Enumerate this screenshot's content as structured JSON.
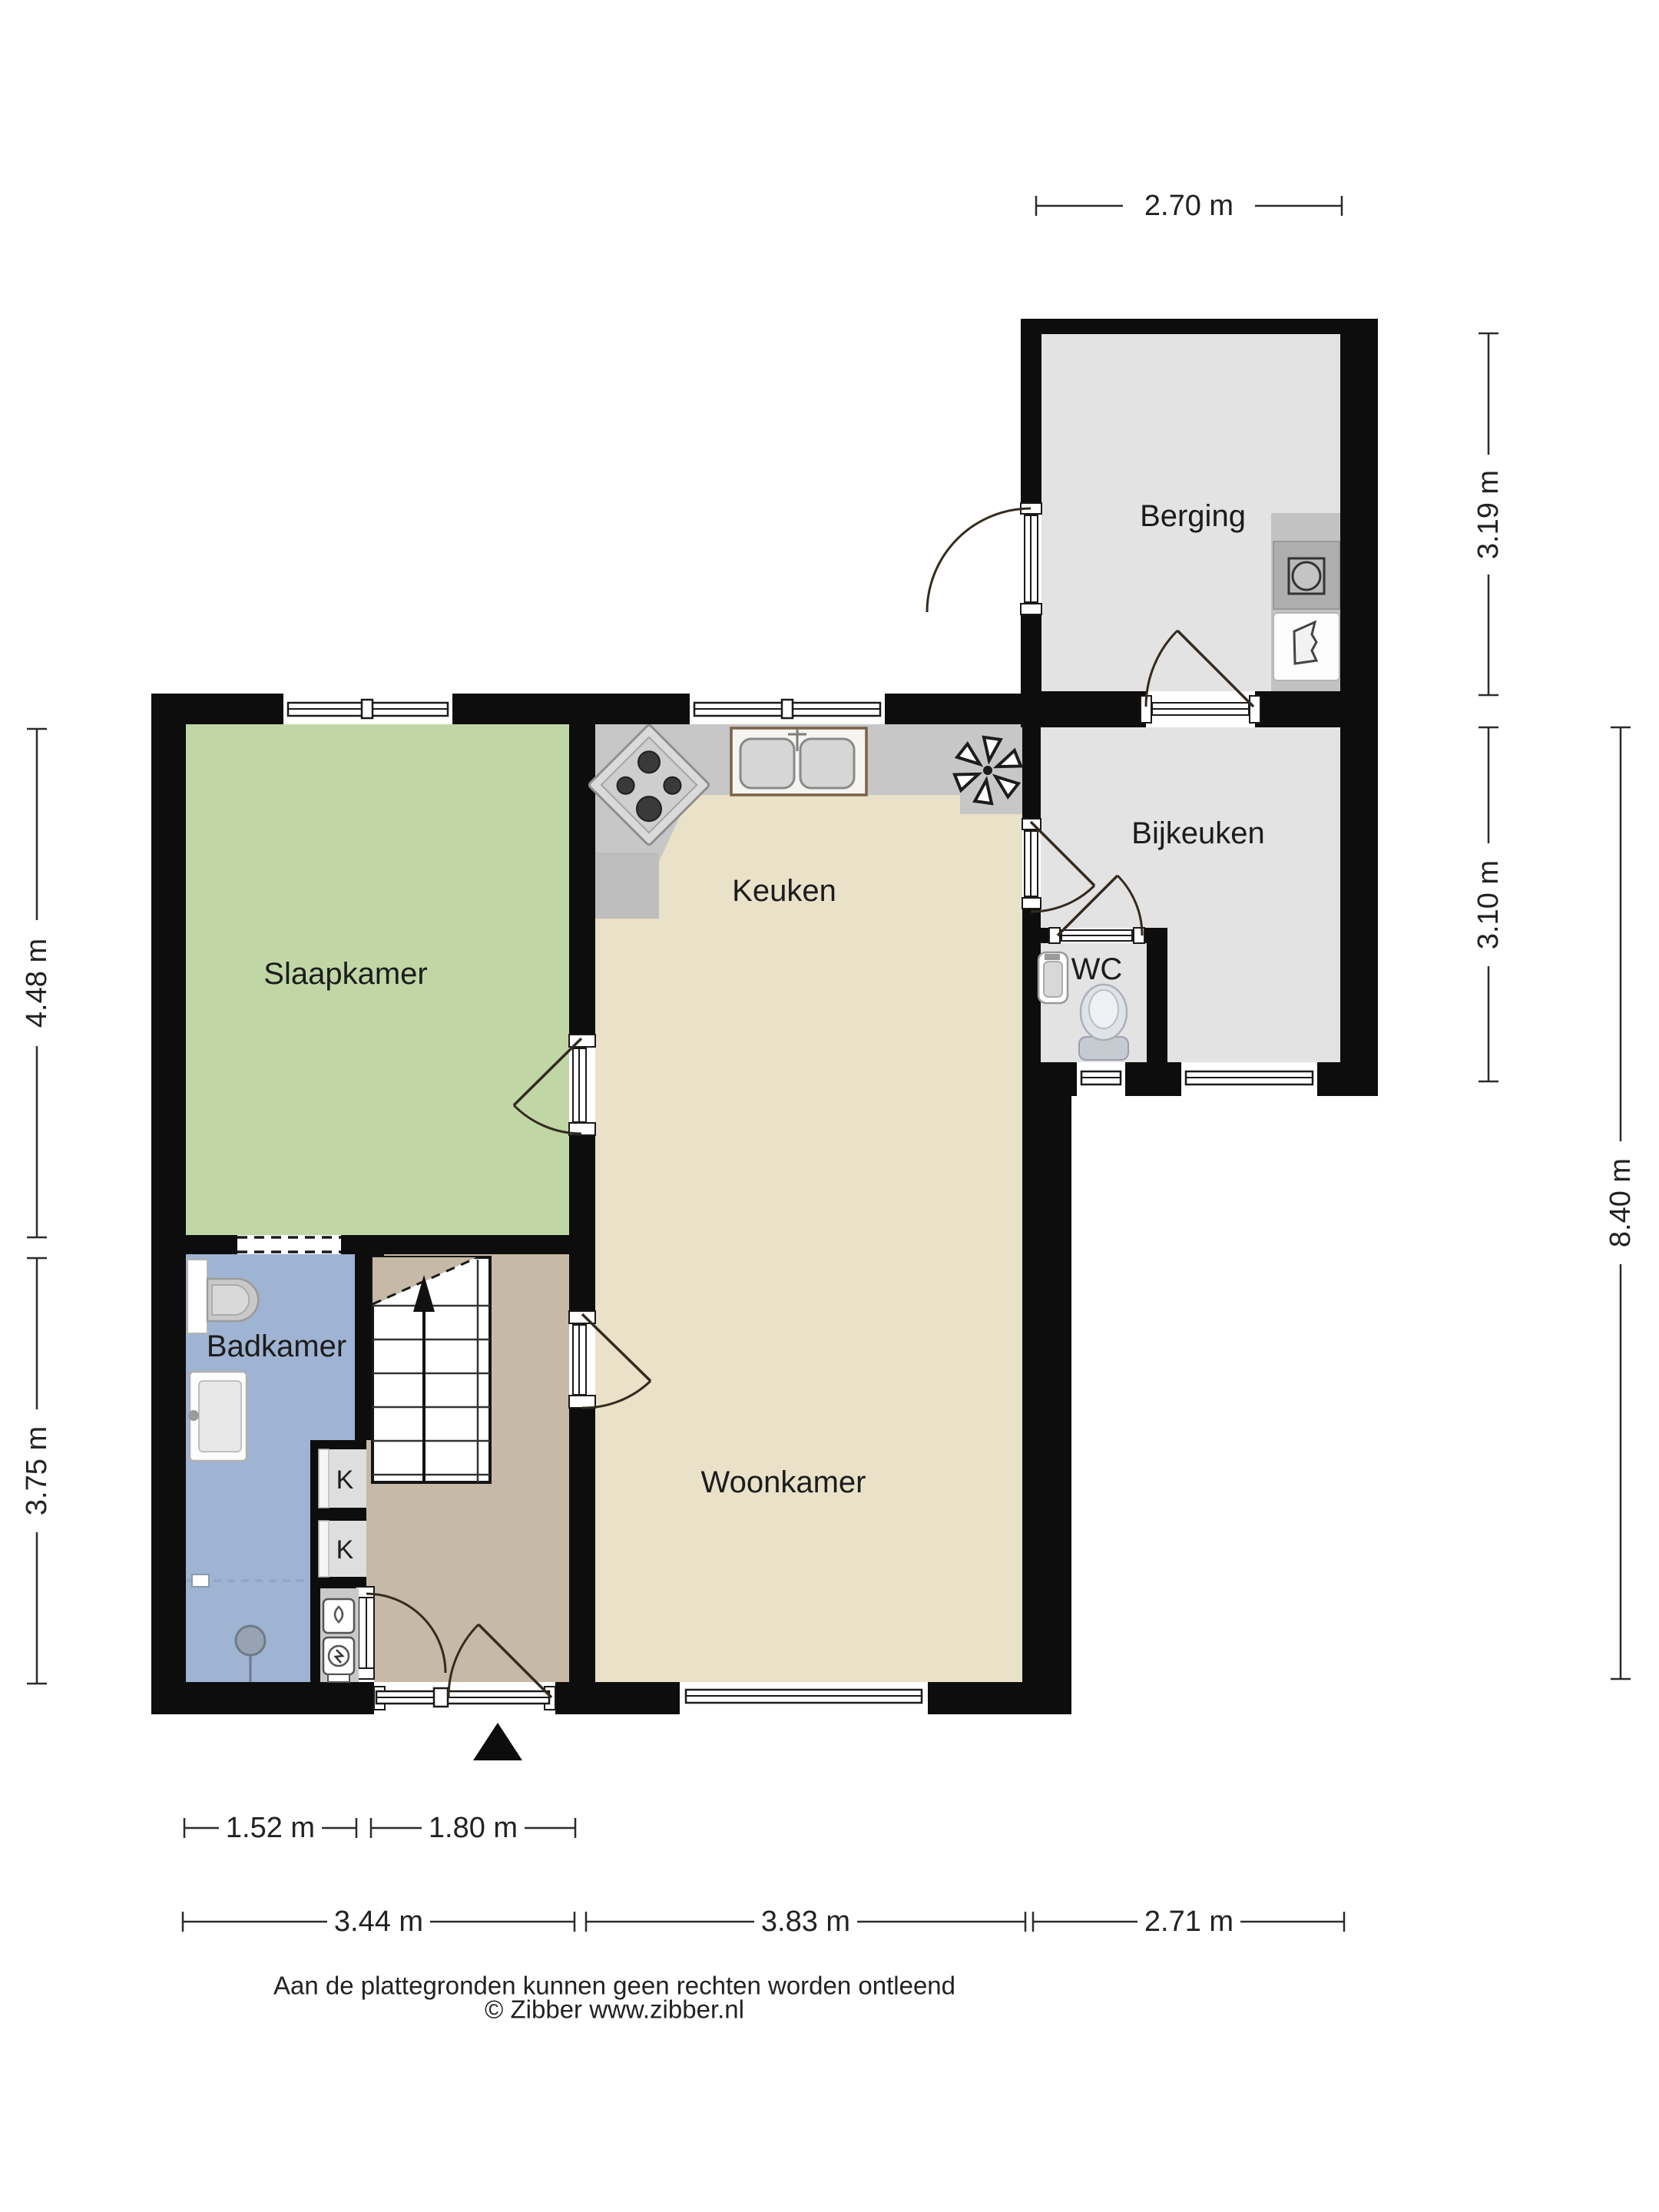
{
  "rooms": {
    "berging": {
      "label": "Berging"
    },
    "bijkeuken": {
      "label": "Bijkeuken"
    },
    "wc": {
      "label": "WC"
    },
    "keuken": {
      "label": "Keuken"
    },
    "slaapkamer": {
      "label": "Slaapkamer"
    },
    "badkamer": {
      "label": "Badkamer"
    },
    "woonkamer": {
      "label": "Woonkamer"
    },
    "closet1": {
      "label": "K"
    },
    "closet2": {
      "label": "K"
    }
  },
  "dimensions": {
    "top_width": "2.70 m",
    "berging_height": "3.19 m",
    "bijkeuken_height": "3.10 m",
    "house_height": "8.40 m",
    "slaapkamer_height": "4.48 m",
    "badkamer_height": "3.75 m",
    "badkamer_width": "1.52 m",
    "hal_width": "1.80 m",
    "bottom_left_width": "3.44 m",
    "bottom_middle_width": "3.83 m",
    "bottom_right_width": "2.71 m"
  },
  "footer": {
    "disclaimer": "Aan de plattegronden kunnen geen rechten worden ontleend",
    "copyright": "© Zibber www.zibber.nl"
  },
  "colors": {
    "background": "#ffffff",
    "wall": "#0d0d0d",
    "bedroom": "#c0d7a5",
    "living": "#e9e1c8",
    "bath": "#9fb3d2",
    "hall": "#c7b9a7",
    "storage": "#e3e3e3",
    "counter": "#c7c7c7"
  }
}
